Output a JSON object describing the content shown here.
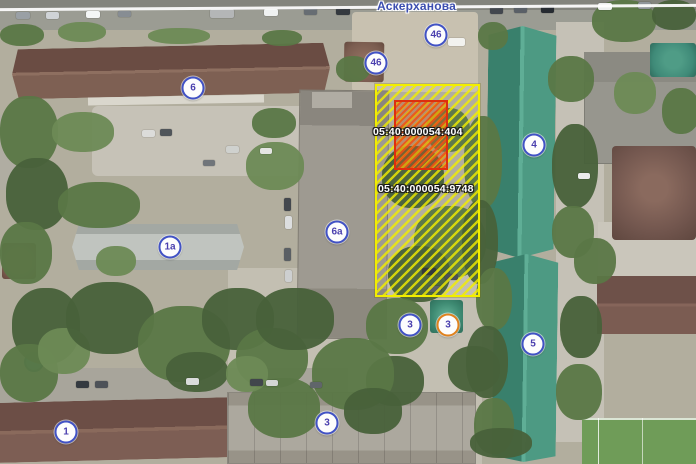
{
  "map": {
    "street_label": "Аскерханова",
    "parcels": [
      {
        "cadastral_number": "05:40:000054:404",
        "kind": "building-outline",
        "outline_color": "#dd2f0e",
        "hatch_color": "#f05014"
      },
      {
        "cadastral_number": "05:40:000054:9748",
        "kind": "land-parcel",
        "outline_color": "#f2ee00",
        "hatch_color": "#f2ee00"
      }
    ],
    "badges": [
      {
        "label": "46",
        "x": 436,
        "y": 35,
        "ring": "blue"
      },
      {
        "label": "46",
        "x": 376,
        "y": 63,
        "ring": "blue"
      },
      {
        "label": "6",
        "x": 193,
        "y": 88,
        "ring": "blue"
      },
      {
        "label": "1а",
        "x": 170,
        "y": 247,
        "ring": "blue"
      },
      {
        "label": "6а",
        "x": 337,
        "y": 232,
        "ring": "blue"
      },
      {
        "label": "4",
        "x": 534,
        "y": 145,
        "ring": "blue"
      },
      {
        "label": "5",
        "x": 533,
        "y": 344,
        "ring": "blue"
      },
      {
        "label": "1",
        "x": 66,
        "y": 432,
        "ring": "blue"
      },
      {
        "label": "3",
        "x": 327,
        "y": 423,
        "ring": "blue"
      },
      {
        "label": "3",
        "x": 410,
        "y": 325,
        "ring": "blue"
      },
      {
        "label": "3",
        "x": 448,
        "y": 325,
        "ring": "orange"
      }
    ],
    "colors": {
      "badge_ring_blue": "#4152c5",
      "badge_ring_orange": "#e0821e",
      "badge_text": "#4a3fae",
      "street_text": "#3c4eb0",
      "parcel_yellow": "#f2ee00",
      "building_red": "#dd2f0e"
    }
  }
}
